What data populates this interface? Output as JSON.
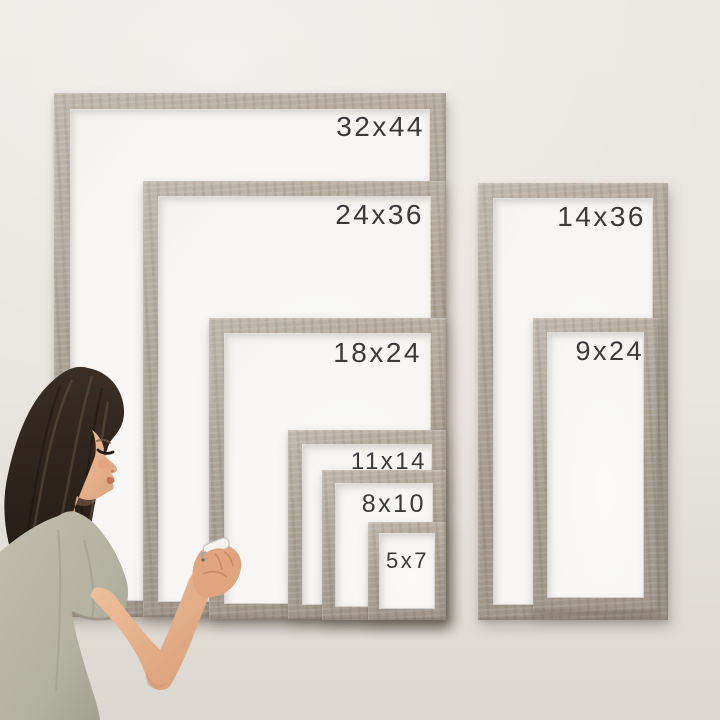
{
  "frames": [
    {
      "label": "32x44",
      "group": "left",
      "rank": 1
    },
    {
      "label": "24x36",
      "group": "left",
      "rank": 2
    },
    {
      "label": "18x24",
      "group": "left",
      "rank": 3
    },
    {
      "label": "11x14",
      "group": "left",
      "rank": 4
    },
    {
      "label": "8x10",
      "group": "left",
      "rank": 5
    },
    {
      "label": "5x7",
      "group": "left",
      "rank": 6
    },
    {
      "label": "14x36",
      "group": "right",
      "rank": 1
    },
    {
      "label": "9x24",
      "group": "right",
      "rank": 2
    }
  ],
  "colors": {
    "wood": "#a79e90",
    "wood_dark": "#8f8678",
    "wood_light": "#b8afa2",
    "wall": "#e9e5e0",
    "wall_bottom": "#dcd7d0",
    "board": "#f7f6f4",
    "label": "#3a3a3a",
    "hair": "#2c231c",
    "skin": "#e2ab85",
    "shirt": "#b3b1a0"
  }
}
